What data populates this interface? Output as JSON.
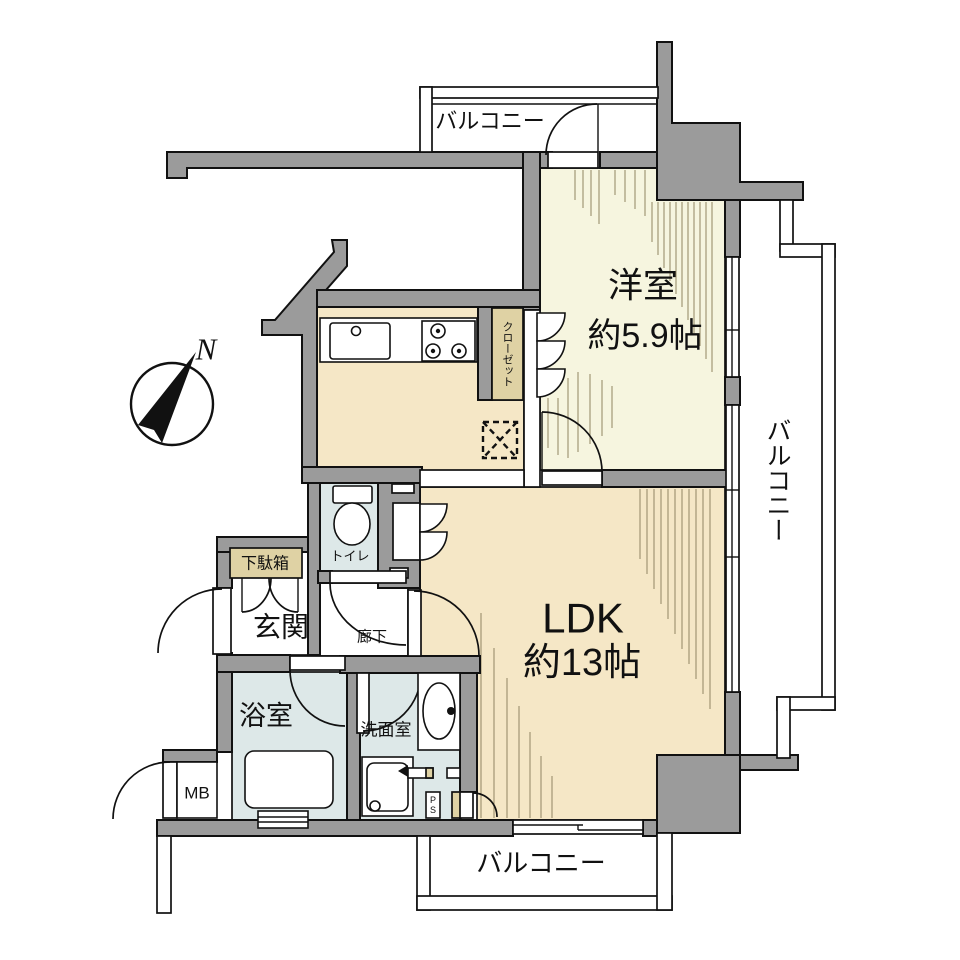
{
  "floorplan": {
    "compass": {
      "north": "N"
    },
    "rooms": {
      "western_room": {
        "name": "洋室",
        "size": "約5.9帖"
      },
      "ldk": {
        "name": "LDK",
        "size": "約13帖"
      },
      "entrance": "玄関",
      "hallway": "廊下",
      "toilet": "トイレ",
      "bathroom": "浴室",
      "washroom": "洗面室",
      "closet": "クローゼット",
      "shoe_cabinet": "下駄箱",
      "meter_box": "MB",
      "pipe_space": "PS",
      "balcony_top": "バルコニー",
      "balcony_right": "バルコニー",
      "balcony_bottom": "バルコニー"
    },
    "colors": {
      "wall": "#9b9b9b",
      "western_room_floor": "#f6f5df",
      "ldk_floor": "#f5e7c6",
      "wet_room_floor": "#dde8e8",
      "storage_tan": "#dfd2a4",
      "line": "#111111",
      "hatch": "#9a8f6d"
    }
  }
}
